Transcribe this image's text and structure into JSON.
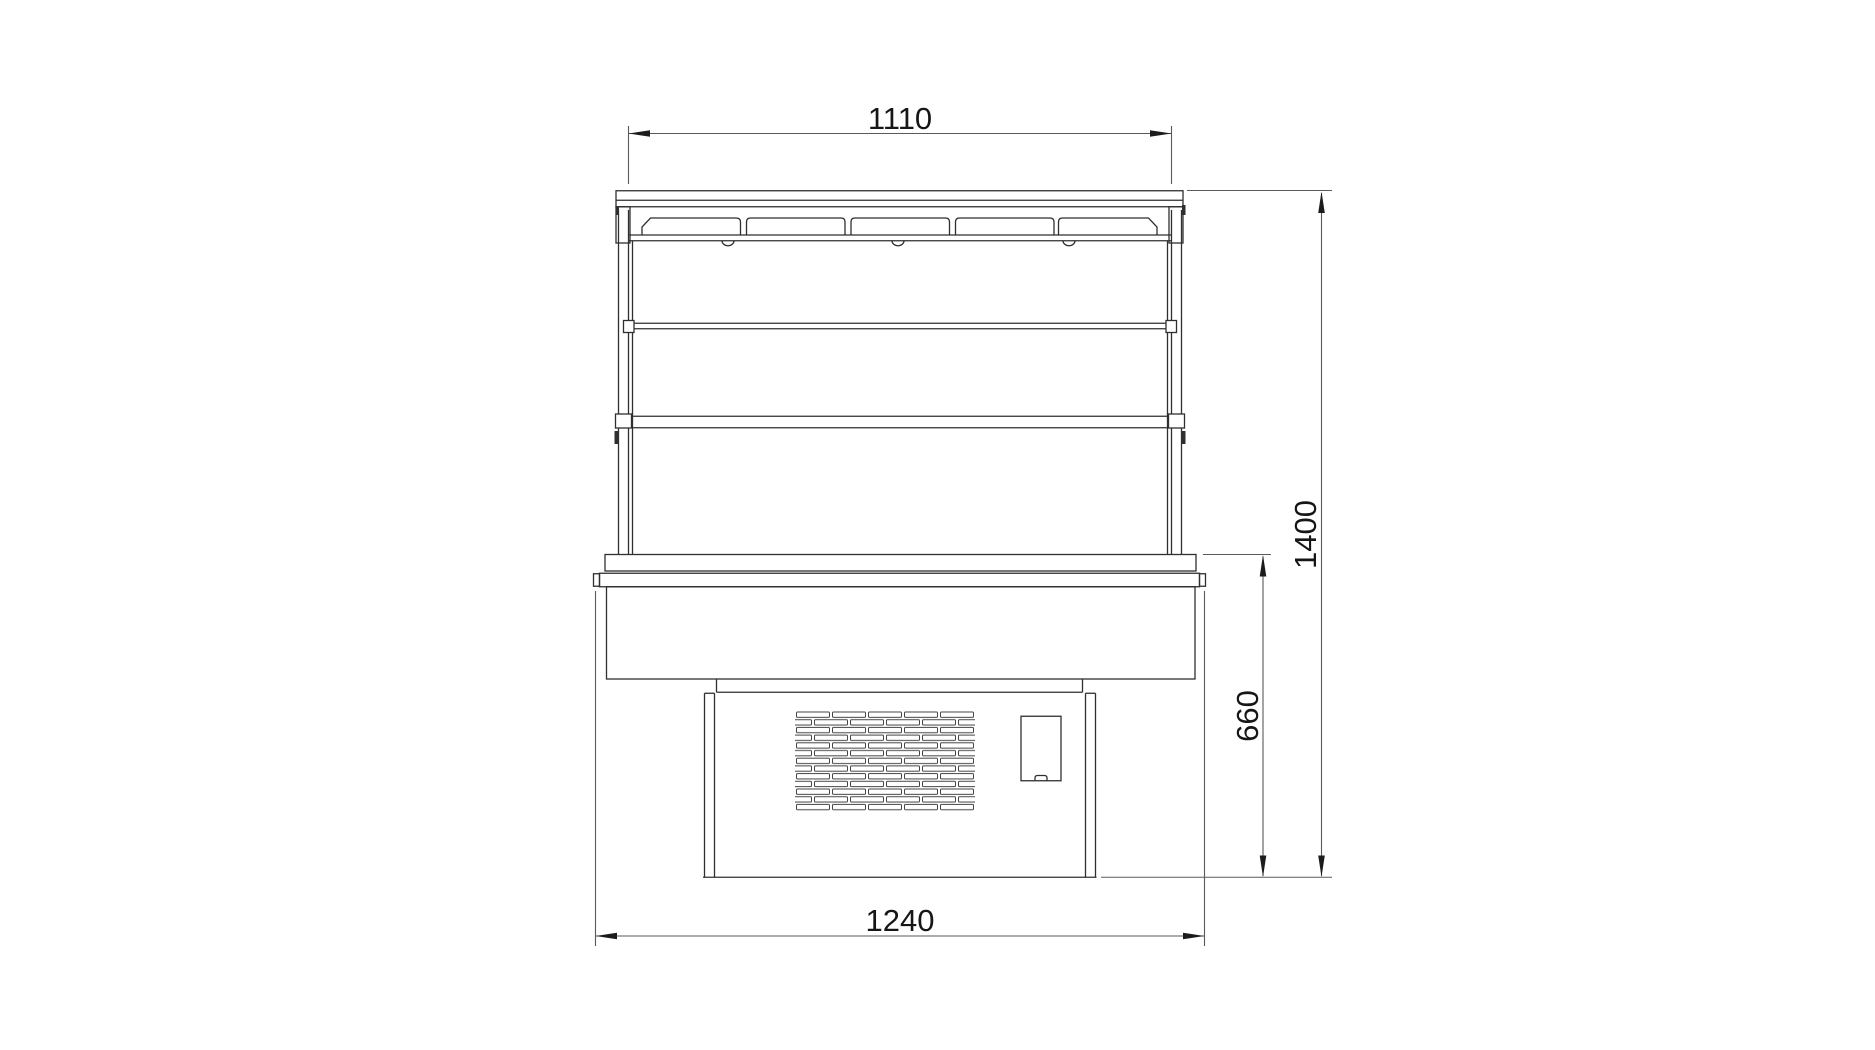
{
  "dimensions": {
    "top_width": "1110",
    "overall_height": "1400",
    "lower_height": "660",
    "base_width": "1240"
  },
  "colors": {
    "background": "#ffffff",
    "object_line": "#2f2f2f",
    "dimension_line": "#5a5a5a",
    "arrow_fill": "#1c1c1c",
    "text": "#161616"
  }
}
